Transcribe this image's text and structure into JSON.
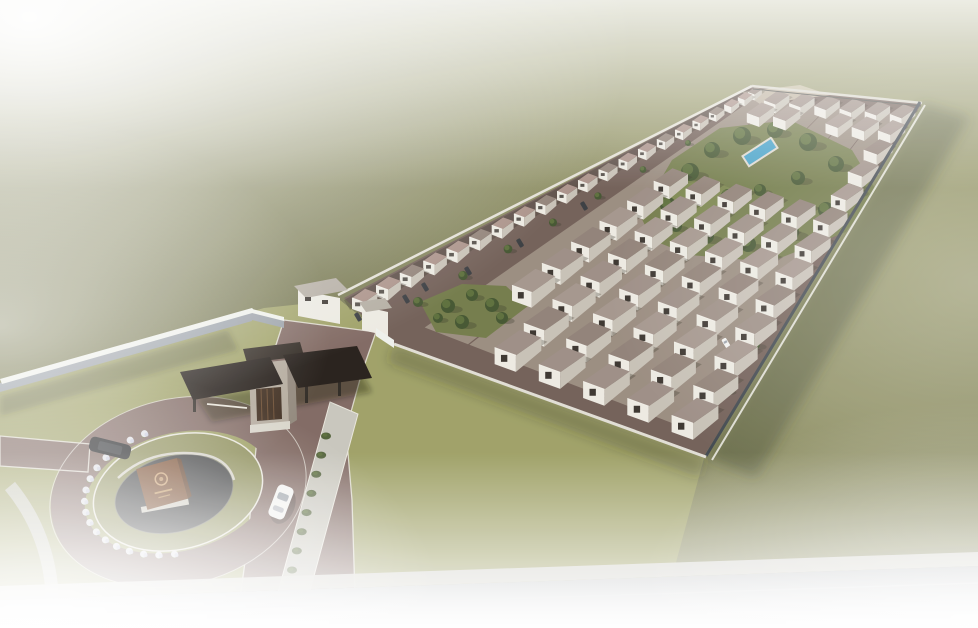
{
  "meta": {
    "description": "aerial 3d render of walled villa compound with entrance gate, roundabout monument, park with pool, and fog vignette"
  },
  "palette": {
    "fieldTop": "#9b9c72",
    "fieldMid": "#7e7f54",
    "fieldBot": "#8a8b60",
    "fieldHi": "#a9aa79",
    "lawn": "#9c9e62",
    "curb": "#e8e5db",
    "roadE": "#7d655e",
    "floor": "#6e5b53",
    "plot": "#b9ae9e",
    "paver": "#c7c5bb",
    "sidewalk": "#d3d2ca",
    "bottomRoad1": "#b6b9bb",
    "bottomRoad2": "#f0f1f1",
    "wallLit": "#ece9e1",
    "wallShade": "#c6bfb4",
    "win": "#352f29",
    "parapet": "#f0ede5",
    "roofA": "#9a8b82",
    "roofB": "#8e7e74",
    "roofC": "#a2938a",
    "roofTown": "#a88f86",
    "park": "#6f7845",
    "parkHi": "#7e894f",
    "treeDark": "#3f512b",
    "treeLite": "#5d7038",
    "pool": "#3f9ec6",
    "poolDeck": "#dcd8ce",
    "berm": "#8c8d58",
    "pit": "#393a3b",
    "pitRim": "#7b7a74",
    "retain": "#d5d2c8",
    "monument": "#744628",
    "monumentSide": "#59361f",
    "monumentBase": "#cfccc1",
    "brass": "#c99c6a",
    "brassLine": "#bf9158",
    "canopy": "#201914",
    "canopy2": "#2a221b",
    "stone": "#b3a99c",
    "stoneSide": "#8f8579",
    "wood": "#3c2a1c",
    "woodLine": "#6b4c30",
    "post": "#2a241e",
    "wallFaceBlue": "#949ba3",
    "wallTop": "#eef0ea",
    "darkWall": "#3c434a",
    "carWhite": "#f2f2f0",
    "carDark": "#1a1b1d",
    "glass": "#9aa1a8",
    "parkedCar": "#34373b",
    "flower1": "#e7e8ee",
    "flower2": "#c7c9dd",
    "tuft": "#6b7343",
    "hedge": "#4c5c33",
    "shadow": "rgba(58,60,36,0.40)",
    "shadowSoft": "rgba(50,50,32,0.30)",
    "houseShadow": "rgba(46,42,30,0.30)",
    "sandPatch": "#cfc5ae"
  },
  "scene": {
    "quad": {
      "a": [
        408,
        330
      ],
      "b": [
        752,
        96
      ],
      "c": [
        908,
        112
      ],
      "d": [
        690,
        440
      ]
    },
    "vRange": [
      0.035,
      0.975
    ],
    "villaRows": [
      {
        "u": 0.1,
        "n": 13,
        "skip": [
          [
            0.64,
            0.88
          ],
          [
            0.02,
            0.18
          ]
        ]
      },
      {
        "u": 0.26,
        "n": 13,
        "skip": [
          [
            0.64,
            0.88
          ]
        ]
      },
      {
        "u": 0.42,
        "n": 13,
        "skip": [
          [
            0.62,
            0.9
          ]
        ]
      },
      {
        "u": 0.58,
        "n": 13,
        "skip": [
          [
            0.62,
            0.86
          ]
        ]
      },
      {
        "u": 0.74,
        "n": 13,
        "skip": [
          [
            0.66,
            0.82
          ]
        ]
      },
      {
        "u": 0.9,
        "n": 13,
        "skip": []
      }
    ],
    "plotBands": [
      [
        0.03,
        0.185
      ],
      [
        0.19,
        0.345
      ],
      [
        0.35,
        0.505
      ],
      [
        0.51,
        0.665
      ],
      [
        0.67,
        0.825
      ],
      [
        0.83,
        0.97
      ]
    ],
    "townhouses": {
      "from": [
        352,
        298
      ],
      "to": [
        748,
        92
      ],
      "n": 21
    },
    "parkTrees": [
      [
        668,
        205,
        8
      ],
      [
        690,
        172,
        9
      ],
      [
        712,
        150,
        8
      ],
      [
        742,
        136,
        9
      ],
      [
        775,
        130,
        8
      ],
      [
        808,
        142,
        9
      ],
      [
        836,
        164,
        8
      ],
      [
        854,
        190,
        7
      ],
      [
        826,
        210,
        8
      ],
      [
        790,
        232,
        9
      ],
      [
        748,
        244,
        8
      ],
      [
        706,
        236,
        8
      ],
      [
        676,
        226,
        6
      ],
      [
        728,
        196,
        7
      ],
      [
        760,
        190,
        6
      ],
      [
        798,
        178,
        7
      ]
    ],
    "pocketTrees": [
      [
        448,
        306,
        7
      ],
      [
        472,
        295,
        6
      ],
      [
        492,
        305,
        7
      ],
      [
        502,
        318,
        6
      ],
      [
        462,
        322,
        7
      ],
      [
        438,
        318,
        5
      ]
    ],
    "wallTrees": [
      [
        872,
        160,
        6
      ],
      [
        858,
        186,
        5
      ],
      [
        812,
        250,
        6
      ],
      [
        780,
        300,
        6
      ],
      [
        754,
        344,
        6
      ],
      [
        726,
        390,
        5
      ]
    ],
    "streetTrees": {
      "from": [
        418,
        302
      ],
      "to": [
        688,
        143
      ],
      "n": 7
    },
    "hedges": {
      "from": [
        326,
        436
      ],
      "to": [
        292,
        570
      ],
      "n": 8
    },
    "flowers": {
      "cx": 175,
      "cy": 490,
      "a": 92,
      "b": 63,
      "rot": -14,
      "start": 100,
      "end": 260,
      "step": 10
    },
    "parkedCars": [
      [
        358,
        317
      ],
      [
        406,
        299
      ],
      [
        425,
        287
      ],
      [
        468,
        271
      ],
      [
        520,
        243
      ],
      [
        584,
        206
      ]
    ],
    "compoundCar": [
      726,
      343
    ],
    "pool": {
      "x": 760,
      "y": 152,
      "w": 34,
      "h": 12,
      "rot": -33
    },
    "cars": {
      "white": {
        "x": 281,
        "y": 502,
        "rot": 21,
        "l": 34,
        "w": 17
      },
      "dark": {
        "x": 110,
        "y": 448,
        "rot": 104,
        "l": 42,
        "w": 15
      }
    }
  }
}
